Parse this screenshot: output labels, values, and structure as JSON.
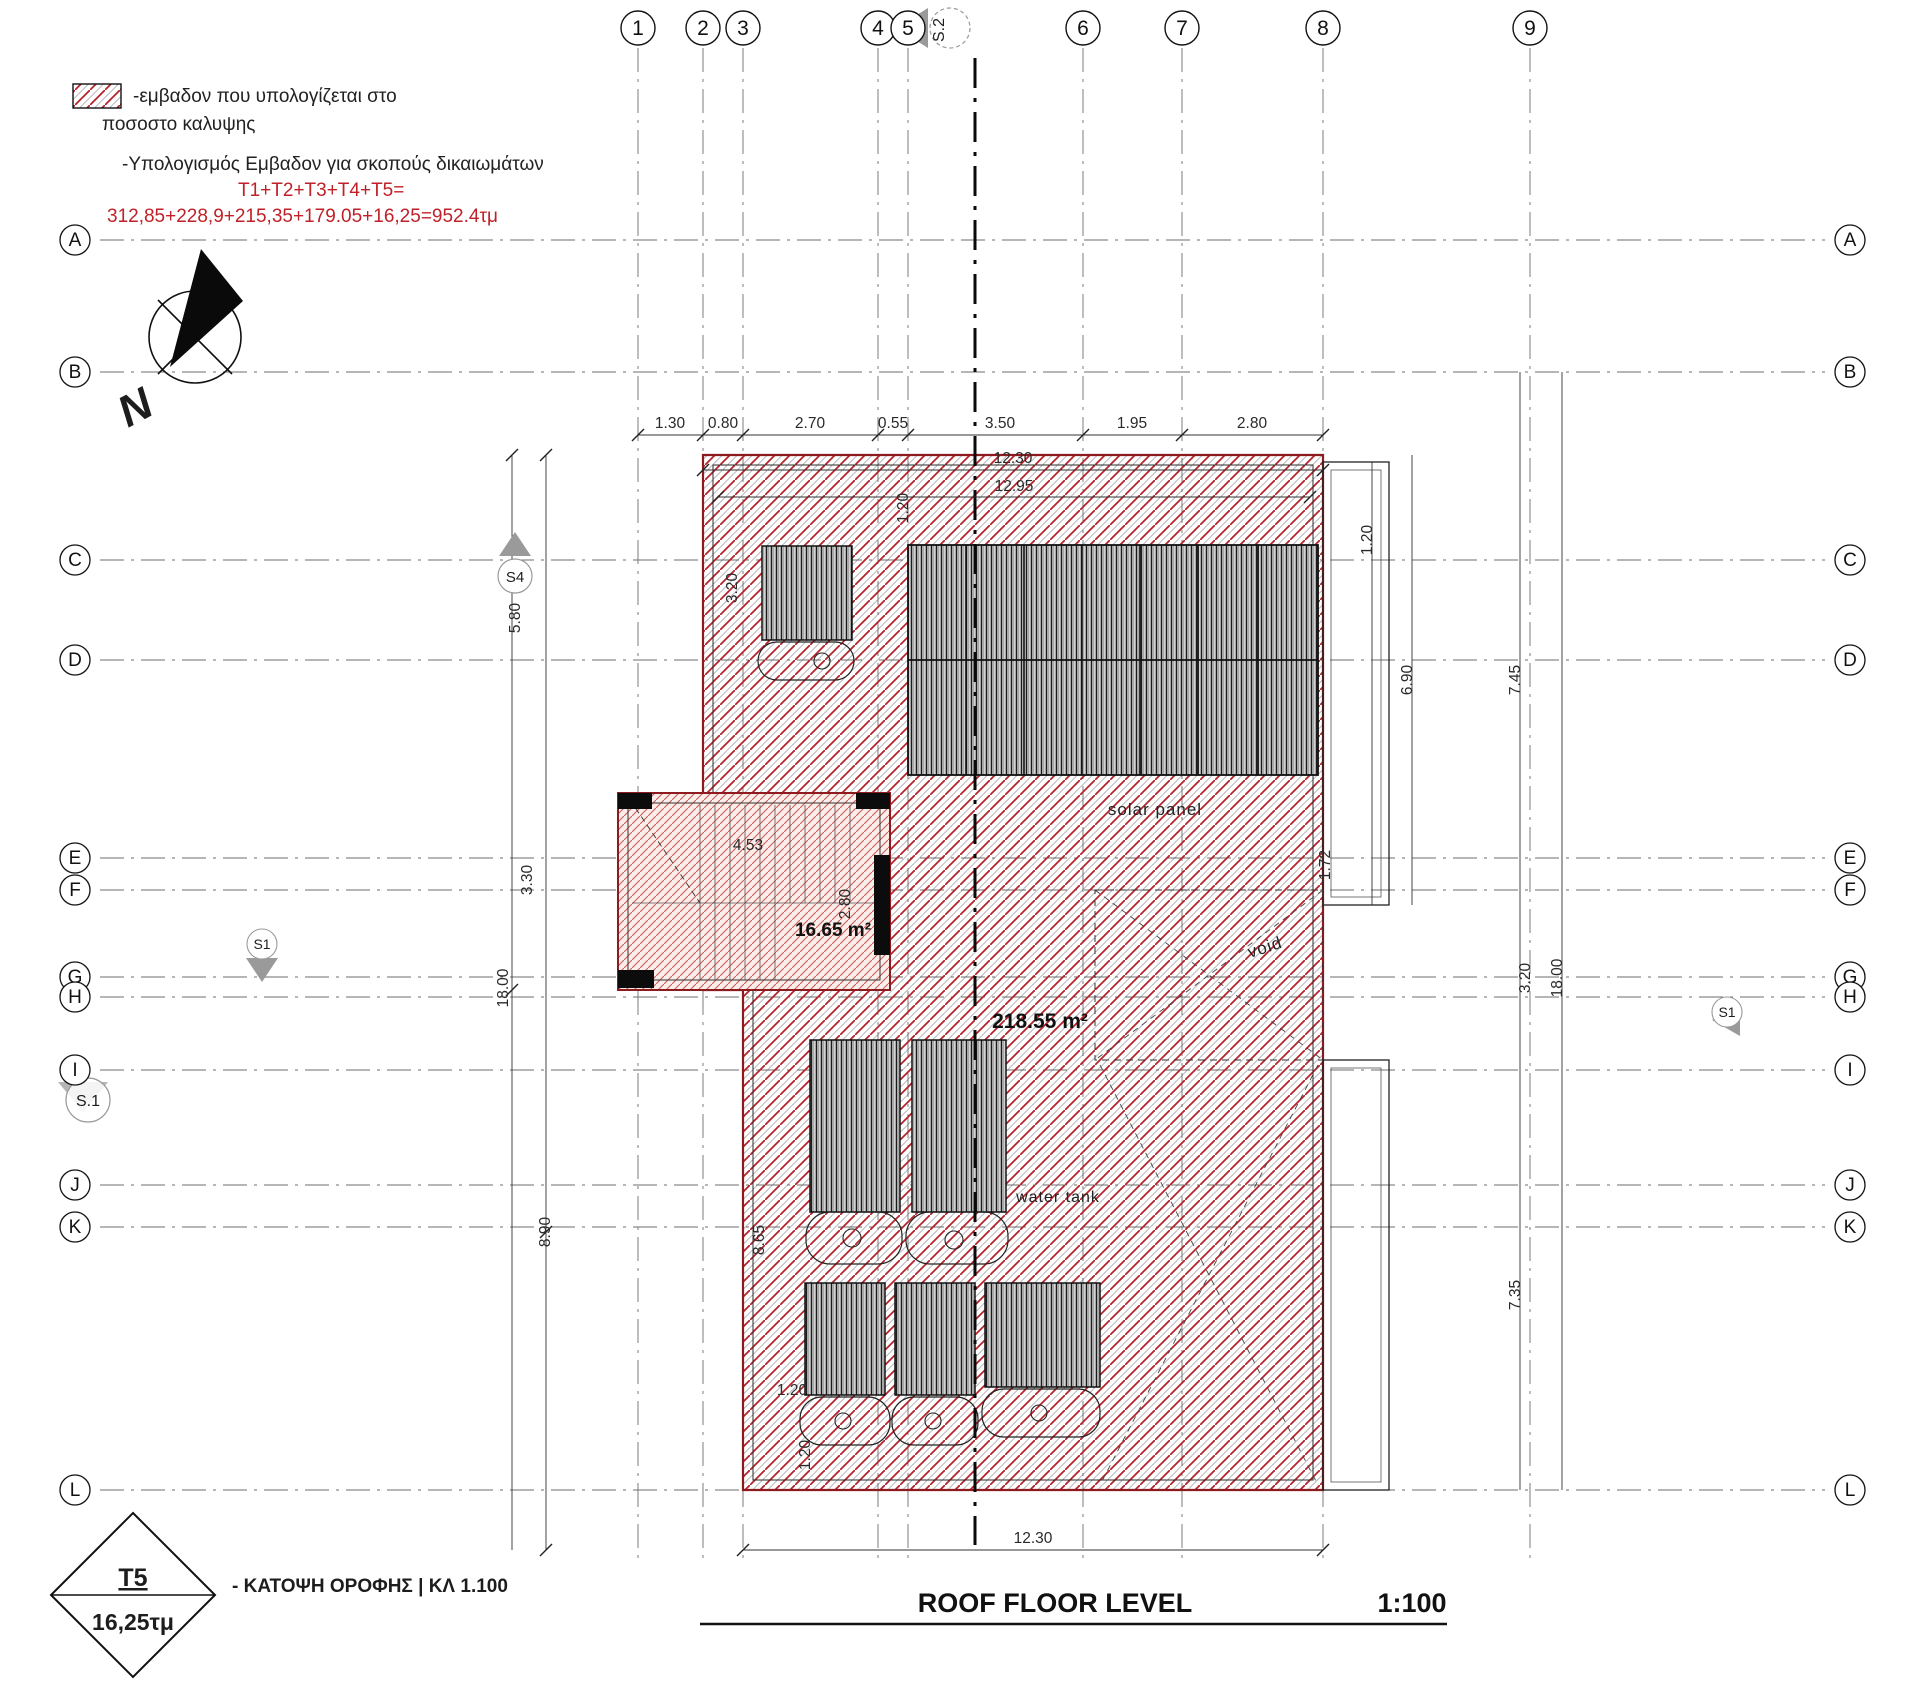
{
  "legend": {
    "hatch_note_line1": "-εμβαδον που υπολογίζεται στο",
    "hatch_note_line2": "ποσοστο καλυψης",
    "calc_note": "-Υπολογισμός Εμβαδον για σκοπούς δικαιωμάτων",
    "calc_formula": "T1+T2+T3+T4+T5=",
    "calc_result": "312,85+228,9+215,35+179.05+16,25=952.4τμ"
  },
  "north": {
    "label": "N"
  },
  "grid": {
    "columns": [
      "1",
      "2",
      "3",
      "4",
      "5",
      "6",
      "7",
      "8",
      "9"
    ],
    "rows": [
      "A",
      "B",
      "C",
      "D",
      "E",
      "F",
      "G",
      "H",
      "I",
      "J",
      "K",
      "L"
    ]
  },
  "sections": {
    "s2": "S.2",
    "s4": "S4",
    "s1_circle": "S.1",
    "s1": "S1"
  },
  "dimensions": {
    "top_chain": [
      "1.30",
      "0.80",
      "2.70",
      "0.55",
      "3.50",
      "1.95",
      "2.80"
    ],
    "top_total": "12.30",
    "inner_top": "12.95",
    "top_small_vertical": "1.20",
    "left": [
      "5.80",
      "3.30",
      "18.00",
      "8.90"
    ],
    "right": [
      "1.20",
      "6.90",
      "7.45",
      "1.72",
      "3.20",
      "18.00",
      "7.35"
    ],
    "bottom_total": "12.30",
    "stair_width": "4.53",
    "stair_depth": "2.80",
    "upper_left_vertical": "3.20",
    "lower_left_vertical": "8.65",
    "bottom_left_h": "1.20",
    "bottom_left_v": "1.20"
  },
  "areas": {
    "stair": "16.65 m²",
    "roof": "218.55 m²"
  },
  "labels": {
    "solar_panel": "solar panel",
    "water_tank": "water tank",
    "void": "void"
  },
  "title": {
    "main": "ROOF FLOOR LEVEL",
    "scale": "1:100"
  },
  "stamp": {
    "code": "T5",
    "area": "16,25τμ",
    "caption": "- ΚΑΤΟΨΗ ΟΡΟΦΗΣ | ΚΛ 1.100"
  },
  "colors": {
    "hatch_red": "#b5232b",
    "text_red": "#c02028",
    "line_black": "#1a1a1a",
    "line_gray": "#8a8a8a"
  }
}
